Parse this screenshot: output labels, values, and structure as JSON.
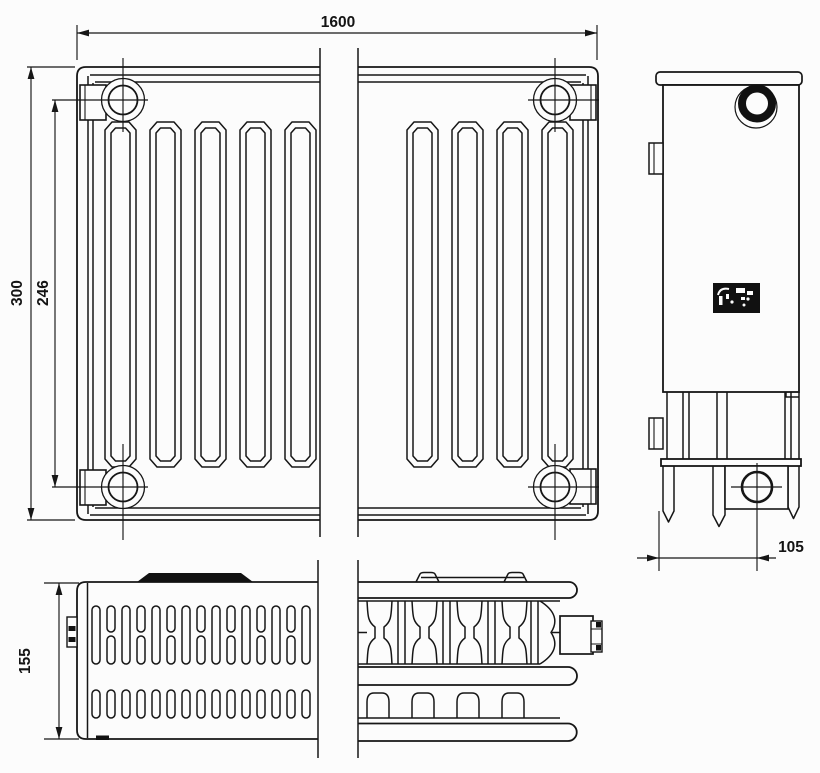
{
  "colors": {
    "background": "#fcfcfc",
    "line": "#161616",
    "label_fill": "#111111"
  },
  "dimensions": {
    "front_width": "1600",
    "front_height": "300",
    "port_spacing": "246",
    "depth": "155",
    "port_offset": "105"
  }
}
